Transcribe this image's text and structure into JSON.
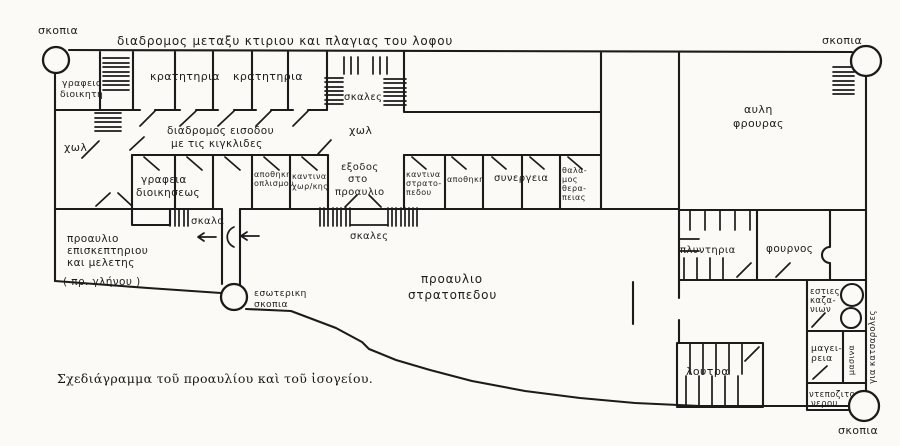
{
  "caption": "Σχεδιάγραμμα τοῦ προαυλίου καὶ τοῦ ἰσογείου.",
  "colors": {
    "ink": "#1b1b1b",
    "paper": "#fbfaf6"
  },
  "labels": {
    "corridor_top": "διαδρομος μεταξυ κτιριου και πλαγιας του λοφου",
    "skopia_top_left": "σκοπια",
    "skopia_top_right": "σκοπια",
    "skopia_bottom_right": "σκοπια",
    "grafeio_dioikiti_1": "γραφειο",
    "grafeio_dioikiti_2": "διοικητη",
    "kratitiria_a": "κρατητηρια",
    "kratitiria_b": "κρατητηρια",
    "skales_top": "σκαλες",
    "xol_left": "χωλ",
    "xol_mid": "χωλ",
    "diadromos_eisodou_1": "διαδρομος εισοδου",
    "diadromos_eisodou_2": "με τις κιγκλιδες",
    "avli_frouras_1": "αυλη",
    "avli_frouras_2": "φρουρας",
    "grafeia_dioikiseos_1": "γραφεια",
    "grafeia_dioikiseos_2": "διοικησεως",
    "apothiki_oplismou_1": "αποθηκη",
    "apothiki_oplismou_2": "οπλισμου",
    "kantina_xorkis_1": "καντινα",
    "kantina_xorkis_2": "χωρ/κης",
    "exodos_1": "εξοδος",
    "exodos_2": "στο",
    "exodos_3": "προαυλιο",
    "kantina_strat_1": "καντινα",
    "kantina_strat_2": "στρατο-",
    "kantina_strat_3": "πεδου",
    "apothiki": "αποθηκη",
    "synergeia": "συνεργεια",
    "thalamos_1": "θαλα-",
    "thalamos_2": "μος",
    "thalamos_3": "θερα-",
    "thalamos_4": "πειας",
    "skala": "σκαλα",
    "skales_bottom": "σκαλες",
    "proavlio_episk_1": "προαυλιο",
    "proavlio_episk_2": "επισκεπτηριου",
    "proavlio_episk_3": "και μελετης",
    "proavlio_episk_4": "( πρ. γλήνου )",
    "esoteriki_skopia_1": "εσωτερικη",
    "esoteriki_skopia_2": "σκοπια",
    "proavlio_strat_1": "προαυλιο",
    "proavlio_strat_2": "στρατοπεδου",
    "plyntiria": "πλυντηρια",
    "fournos": "φουρνος",
    "esties_1": "εστιες",
    "esties_2": "καζα-",
    "esties_3": "νιων",
    "mageireia_1": "μαγει-",
    "mageireia_2": "ρεια",
    "masina": "μασινα",
    "gia_katsaroles": "για κατσαρολες",
    "ntepozito_1": "ντεποζιτο",
    "ntepozito_2": "νερου",
    "loutra": "λουτρα"
  }
}
